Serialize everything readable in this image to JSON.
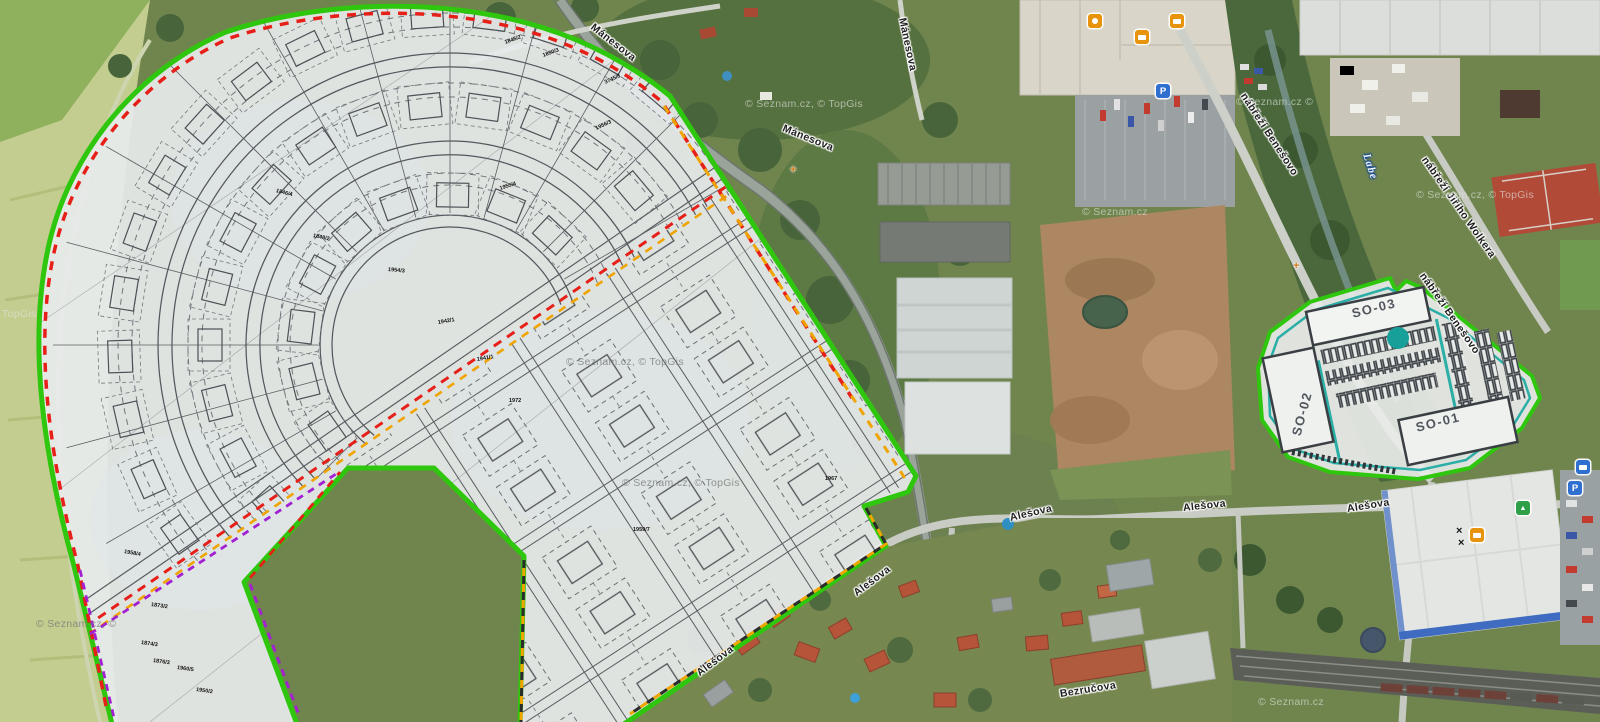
{
  "map": {
    "name": "aerial-development-plan-map",
    "attribution": "© Seznam.cz, © TopGis"
  },
  "labels": {
    "streets": [
      {
        "text": "Mánesova"
      },
      {
        "text": "Mánesova"
      },
      {
        "text": "Mánesova"
      },
      {
        "text": "nábřeží Benešovo"
      },
      {
        "text": "nábřeží Jiřího Wolkera"
      },
      {
        "text": "nábřeží Benešovo"
      },
      {
        "text": "Alešova"
      },
      {
        "text": "Alešova"
      },
      {
        "text": "Alešova"
      },
      {
        "text": "Alešova"
      },
      {
        "text": "Alešova"
      },
      {
        "text": "Bezručova"
      }
    ],
    "river": {
      "text": "Labe"
    },
    "site_buildings": [
      {
        "text": "SO-03"
      },
      {
        "text": "SO-02"
      },
      {
        "text": "SO-01"
      }
    ],
    "parcels": [
      {
        "text": "1845/2"
      },
      {
        "text": "1850/3"
      },
      {
        "text": "3745/8"
      },
      {
        "text": "1956/3"
      },
      {
        "text": "1846/4"
      },
      {
        "text": "1848/2"
      },
      {
        "text": "1955/4"
      },
      {
        "text": "1954/3"
      },
      {
        "text": "1942/1"
      },
      {
        "text": "1941/1"
      },
      {
        "text": "1972"
      },
      {
        "text": "1967"
      },
      {
        "text": "1959/7"
      },
      {
        "text": "1958/4"
      },
      {
        "text": "1873/2"
      },
      {
        "text": "1874/3"
      },
      {
        "text": "1876/3"
      },
      {
        "text": "1960/5"
      },
      {
        "text": "1950/2"
      }
    ],
    "watermarks": [
      {
        "text": "© Seznam.cz, © TopGis"
      },
      {
        "text": "© Seznam.cz, © TopGis"
      },
      {
        "text": "© Seznam.cz, © TopGis"
      },
      {
        "text": "© Seznam.cz, © TopGis"
      },
      {
        "text": "© Seznam.cz"
      },
      {
        "text": "© Seznam.cz"
      },
      {
        "text": "© Seznam.cz, ©"
      },
      {
        "text": "TopGis"
      },
      {
        "text": "© Seznam.cz ©"
      }
    ]
  },
  "icons": [
    {
      "name": "parking-icon",
      "glyph": "P"
    },
    {
      "name": "parking-icon",
      "glyph": "P"
    },
    {
      "name": "shopping-cart-icon",
      "glyph": ""
    },
    {
      "name": "shopping-basket-icon",
      "glyph": ""
    },
    {
      "name": "furniture-icon",
      "glyph": ""
    },
    {
      "name": "lock-icon",
      "glyph": ""
    },
    {
      "name": "recycling-icon",
      "glyph": "▲"
    },
    {
      "name": "vehicle-icon",
      "glyph": ""
    },
    {
      "name": "monument-icon",
      "glyph": "+"
    },
    {
      "name": "monument-icon",
      "glyph": "+"
    },
    {
      "name": "roof-cross-icon",
      "glyph": "×"
    },
    {
      "name": "roof-cross-icon",
      "glyph": "×"
    }
  ],
  "legend_colors": {
    "site_boundary_green": "#2ec70d",
    "restriction_red": "#e62019",
    "phase_orange": "#efa400",
    "zone_purple": "#a21fd2",
    "plan_teal": "#2aaea6"
  }
}
